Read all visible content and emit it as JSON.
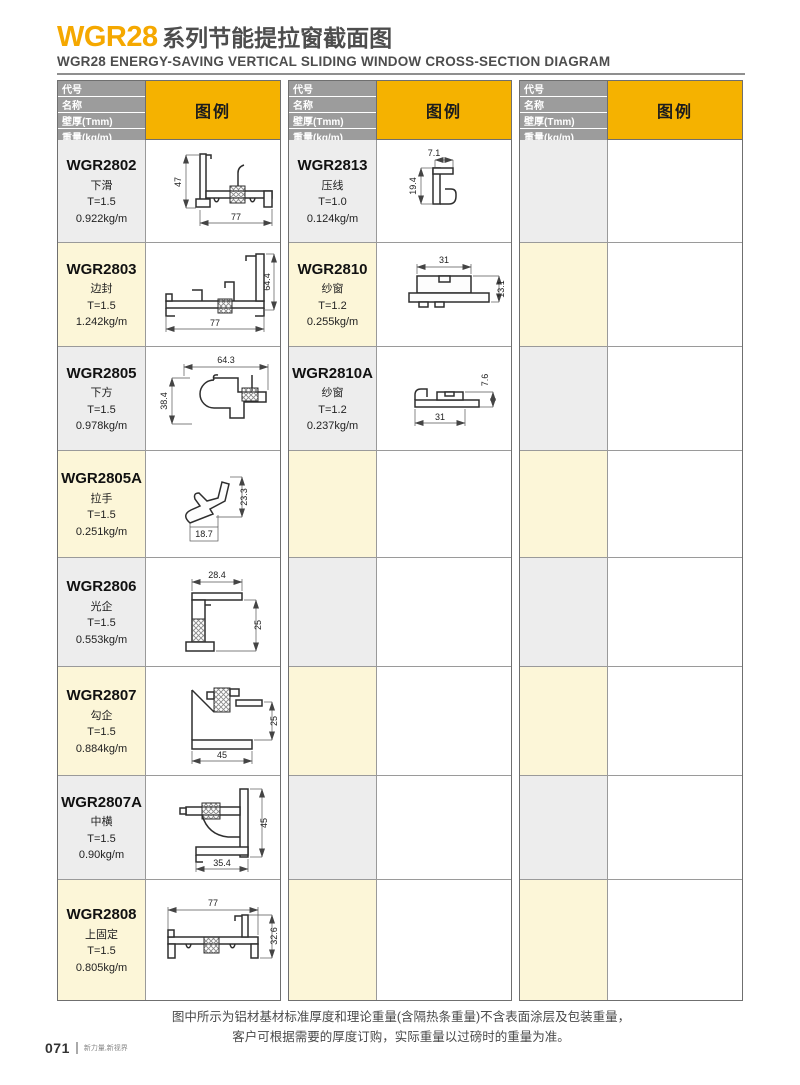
{
  "header": {
    "title_code": "WGR28",
    "title_cn": "系列节能提拉窗截面图",
    "subtitle": "WGR28 ENERGY-SAVING VERTICAL SLIDING WINDOW CROSS-SECTION DIAGRAM"
  },
  "table_header": {
    "row1": "代号",
    "row2": "名称",
    "row3": "壁厚(Tmm)",
    "row4": "重量(kg/m)",
    "legend": "图例"
  },
  "colors": {
    "accent_orange": "#F5A800",
    "legend_yellow": "#F5B200",
    "header_gray": "#9C9C9C",
    "row_gray": "#EDEDED",
    "row_cream": "#FCF6D8"
  },
  "products": {
    "col1": [
      {
        "code": "WGR2802",
        "name": "下滑",
        "thickness": "T=1.5",
        "weight": "0.922kg/m",
        "dim_h": "47",
        "dim_w": "77"
      },
      {
        "code": "WGR2803",
        "name": "边封",
        "thickness": "T=1.5",
        "weight": "1.242kg/m",
        "dim_h": "64.4",
        "dim_w": "77"
      },
      {
        "code": "WGR2805",
        "name": "下方",
        "thickness": "T=1.5",
        "weight": "0.978kg/m",
        "dim_h": "38.4",
        "dim_w": "64.3"
      },
      {
        "code": "WGR2805A",
        "name": "拉手",
        "thickness": "T=1.5",
        "weight": "0.251kg/m",
        "dim_h": "23.3",
        "dim_w": "18.7"
      },
      {
        "code": "WGR2806",
        "name": "光企",
        "thickness": "T=1.5",
        "weight": "0.553kg/m",
        "dim_h": "25",
        "dim_w": "28.4"
      },
      {
        "code": "WGR2807",
        "name": "勾企",
        "thickness": "T=1.5",
        "weight": "0.884kg/m",
        "dim_h": "25",
        "dim_w": "45"
      },
      {
        "code": "WGR2807A",
        "name": "中横",
        "thickness": "T=1.5",
        "weight": "0.90kg/m",
        "dim_h": "45",
        "dim_w": "35.4"
      },
      {
        "code": "WGR2808",
        "name": "上固定",
        "thickness": "T=1.5",
        "weight": "0.805kg/m",
        "dim_h": "32.6",
        "dim_w": "77"
      }
    ],
    "col2": [
      {
        "code": "WGR2813",
        "name": "压线",
        "thickness": "T=1.0",
        "weight": "0.124kg/m",
        "dim_h": "19.4",
        "dim_w": "7.1"
      },
      {
        "code": "WGR2810",
        "name": "纱窗",
        "thickness": "T=1.2",
        "weight": "0.255kg/m",
        "dim_h": "13.1",
        "dim_w": "31"
      },
      {
        "code": "WGR2810A",
        "name": "纱窗",
        "thickness": "T=1.2",
        "weight": "0.237kg/m",
        "dim_h": "7.6",
        "dim_w": "31"
      }
    ]
  },
  "footer": {
    "note_line1": "图中所示为铝材基材标准厚度和理论重量(含隔热条重量)不含表面涂层及包装重量，",
    "note_line2": "客户可根据需要的厚度订购，实际重量以过磅时的重量为准。",
    "page_number": "071",
    "tagline": "新力量,新视界"
  }
}
